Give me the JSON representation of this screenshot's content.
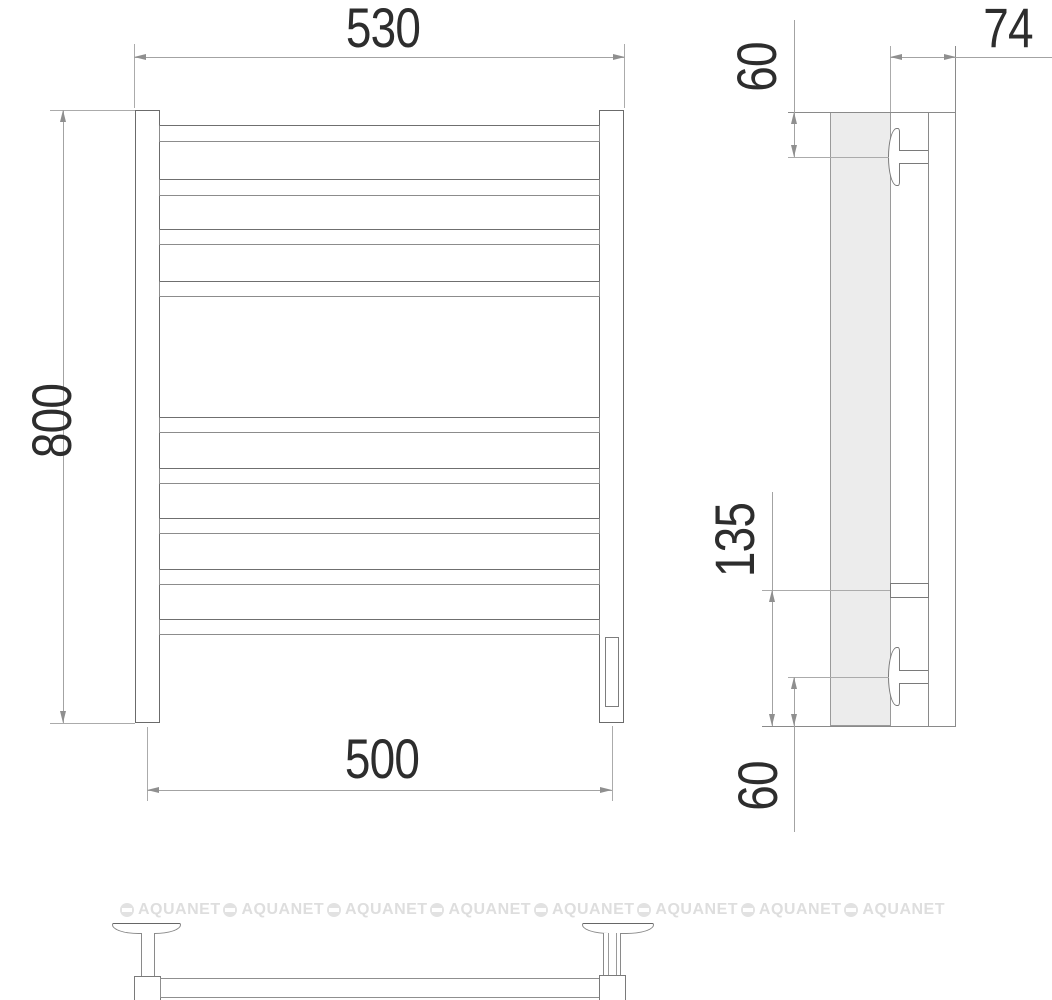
{
  "drawing": {
    "product": "towel-rail-technical-drawing",
    "front_view": {
      "width_overall_mm": "530",
      "height_mm": "800",
      "rail_axis_spacing_mm": "500"
    },
    "side_view": {
      "depth_mm": "74",
      "top_bracket_offset_mm": "60",
      "inlet_height_mm": "135",
      "bottom_bracket_offset_mm": "60"
    },
    "watermark": {
      "text": "AQUANET",
      "color": "#dedede"
    },
    "colors": {
      "contour": "#6b6b6b",
      "dimension_lines": "#a3a3a3",
      "dimension_text": "#2d2d2d",
      "profile_fill": "#ececec"
    }
  }
}
